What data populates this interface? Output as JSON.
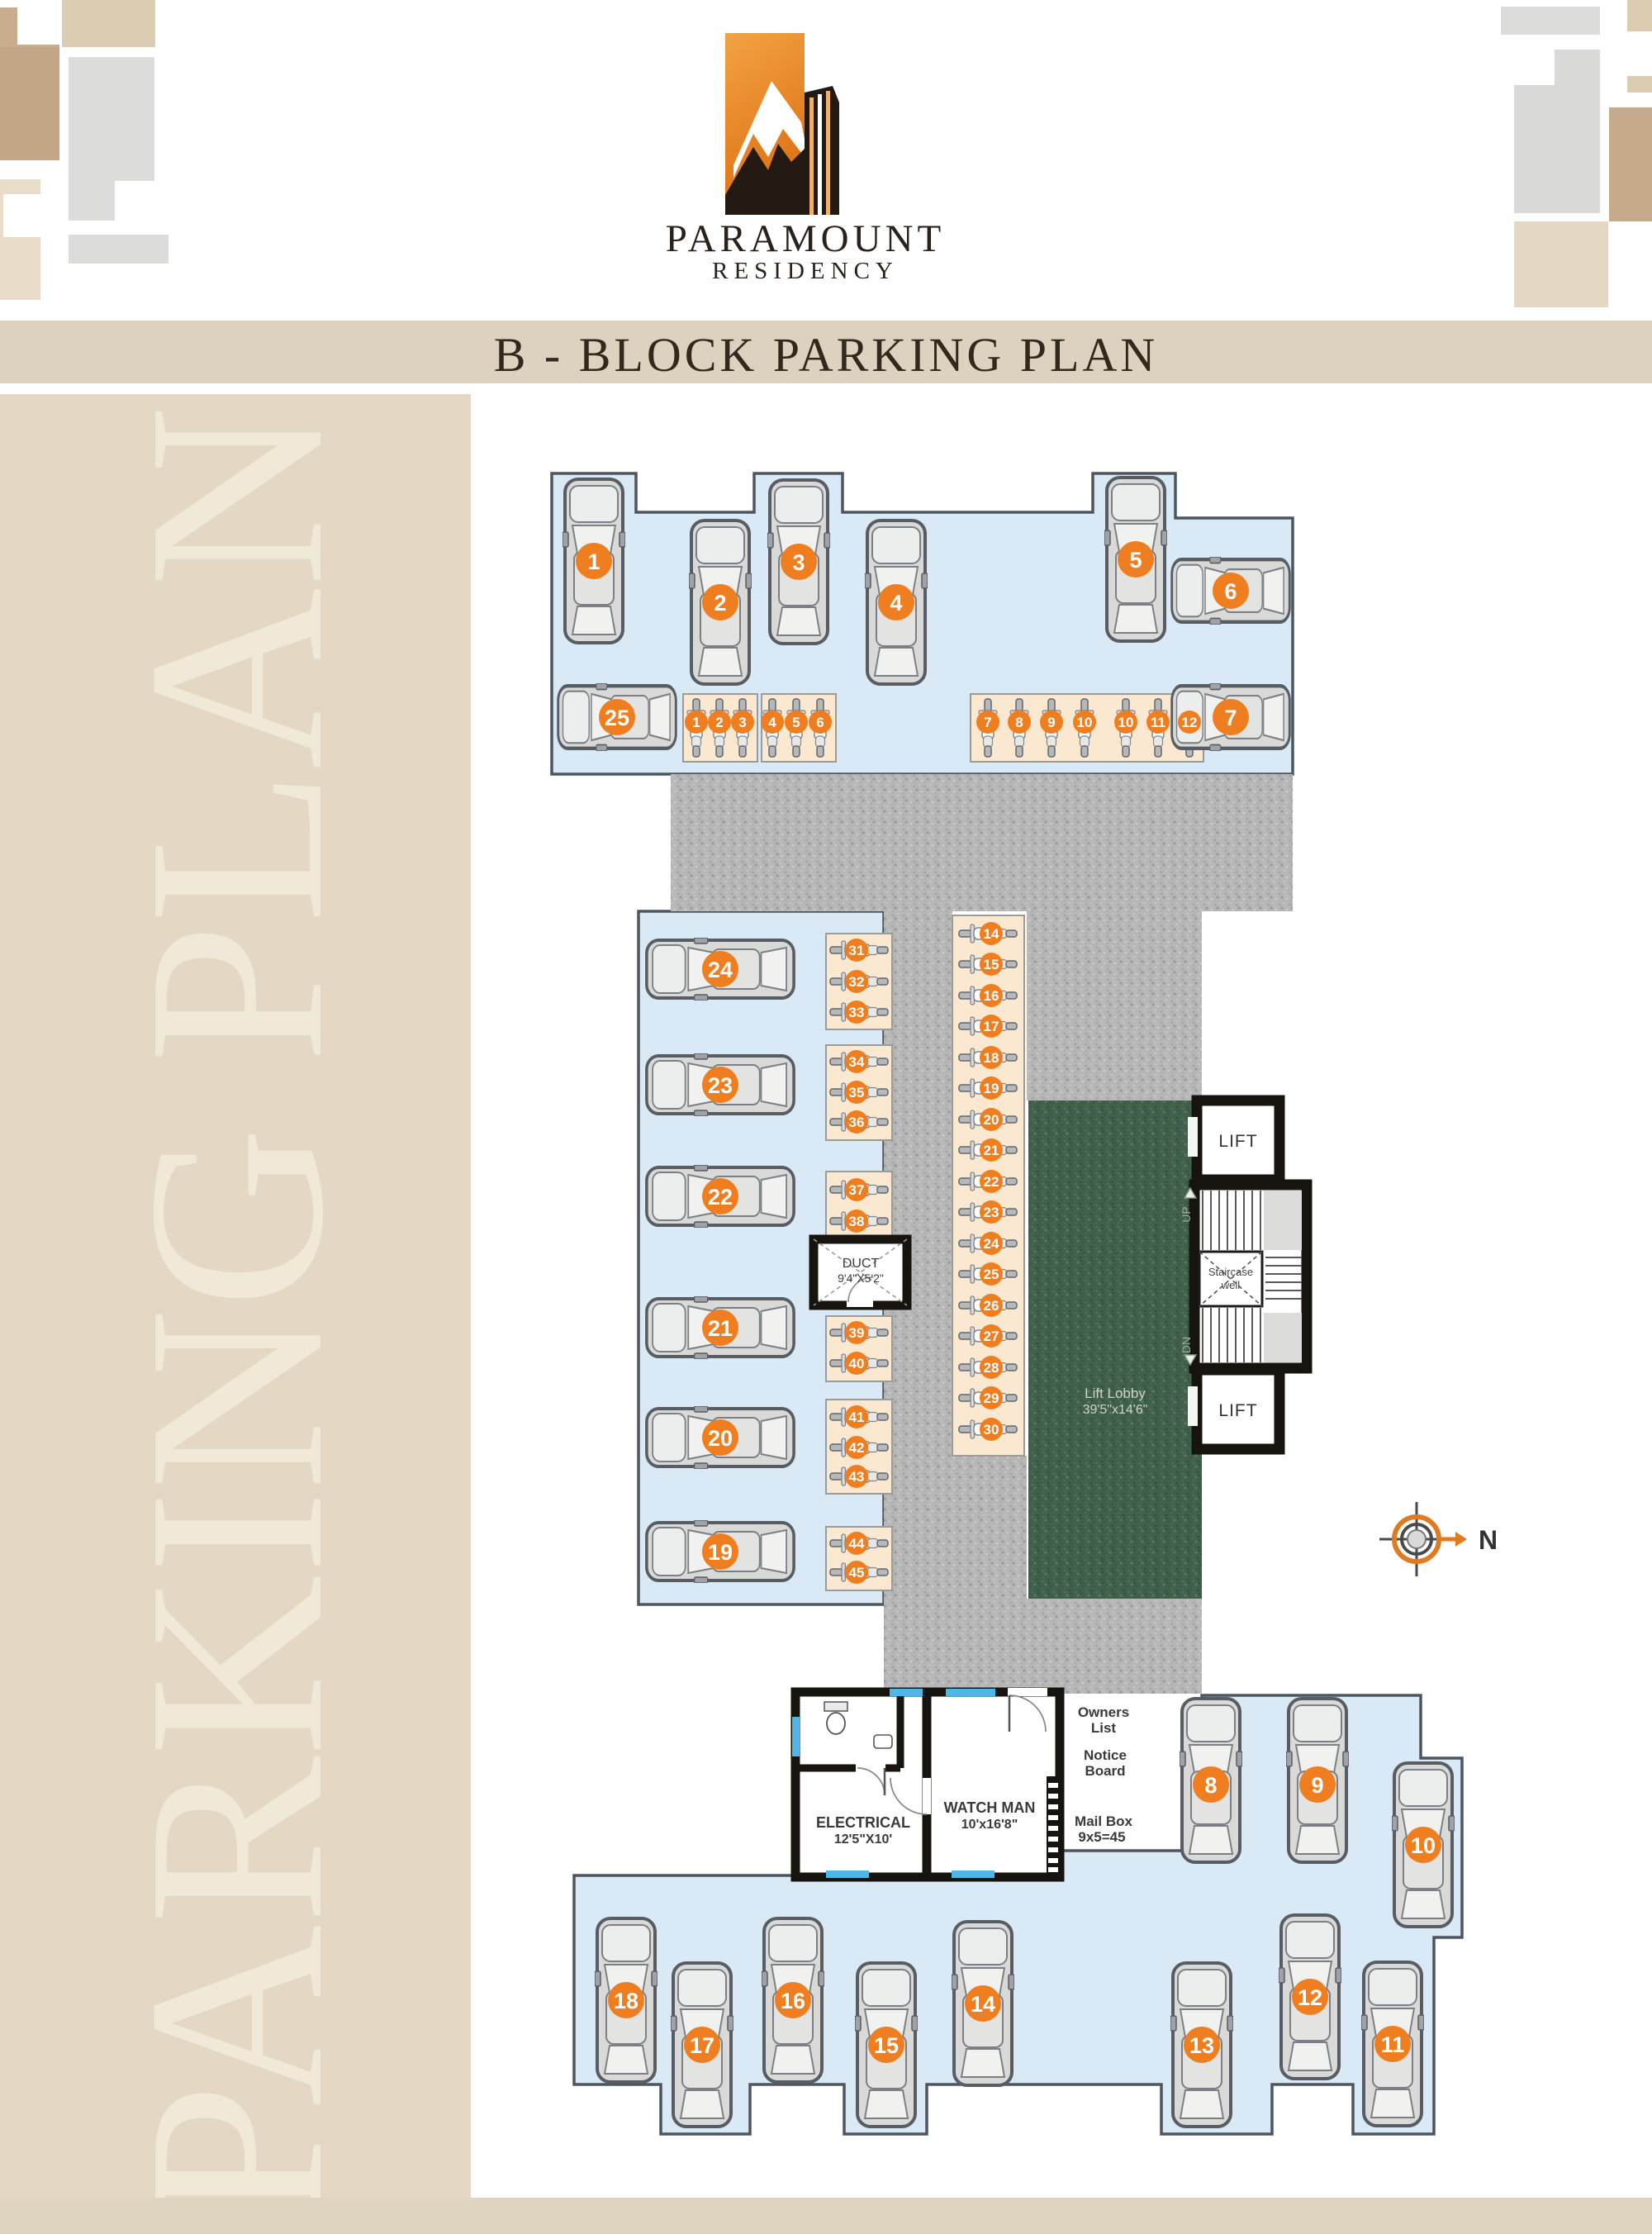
{
  "header": {
    "logo_title": "PARAMOUNT",
    "logo_subtitle": "RESIDENCY",
    "page_title": "B - BLOCK PARKING PLAN"
  },
  "sidebar": {
    "text": "PARKING PLAN"
  },
  "colors": {
    "accent_orange": "#ee7e1f",
    "parking_blue": "#d9e9f6",
    "road_gray": "#b7b7b7",
    "lobby_green": "#41604b",
    "bike_strip_peach": "#fbe8d0",
    "beige": "#e4d7c3"
  },
  "plan": {
    "car_spots": [
      "1",
      "2",
      "3",
      "4",
      "5",
      "6",
      "7",
      "8",
      "9",
      "10",
      "11",
      "12",
      "13",
      "14",
      "15",
      "16",
      "17",
      "18",
      "19",
      "20",
      "21",
      "22",
      "23",
      "24",
      "25"
    ],
    "bike_spots_top": [
      "1",
      "2",
      "3",
      "4",
      "5",
      "6",
      "7",
      "8",
      "9",
      "10",
      "10",
      "11",
      "12"
    ],
    "bike_spots_left": [
      "31",
      "32",
      "33",
      "34",
      "35",
      "36",
      "37",
      "38",
      "39",
      "40",
      "41",
      "42",
      "43",
      "44",
      "45"
    ],
    "bike_spots_right": [
      "14",
      "15",
      "16",
      "17",
      "18",
      "19",
      "20",
      "21",
      "22",
      "23",
      "24",
      "25",
      "26",
      "27",
      "28",
      "29",
      "30"
    ],
    "duct": {
      "name": "DUCT",
      "size": "9'4\"X5'2\""
    },
    "lift_label": "LIFT",
    "staircase_line1": "Staircase",
    "staircase_line2": "well",
    "up": "UP",
    "dn": "DN",
    "lift_lobby": {
      "name": "Lift Lobby",
      "size": "39'5\"x14'6\""
    },
    "electrical": {
      "name": "ELECTRICAL",
      "size": "12'5\"X10'"
    },
    "watchman": {
      "name": "WATCH MAN",
      "size": "10'x16'8\""
    },
    "owners_list_1": "Owners",
    "owners_list_2": "List",
    "notice_board_1": "Notice",
    "notice_board_2": "Board",
    "mail_box_1": "Mail Box",
    "mail_box_2": "9x5=45",
    "north": "N"
  }
}
